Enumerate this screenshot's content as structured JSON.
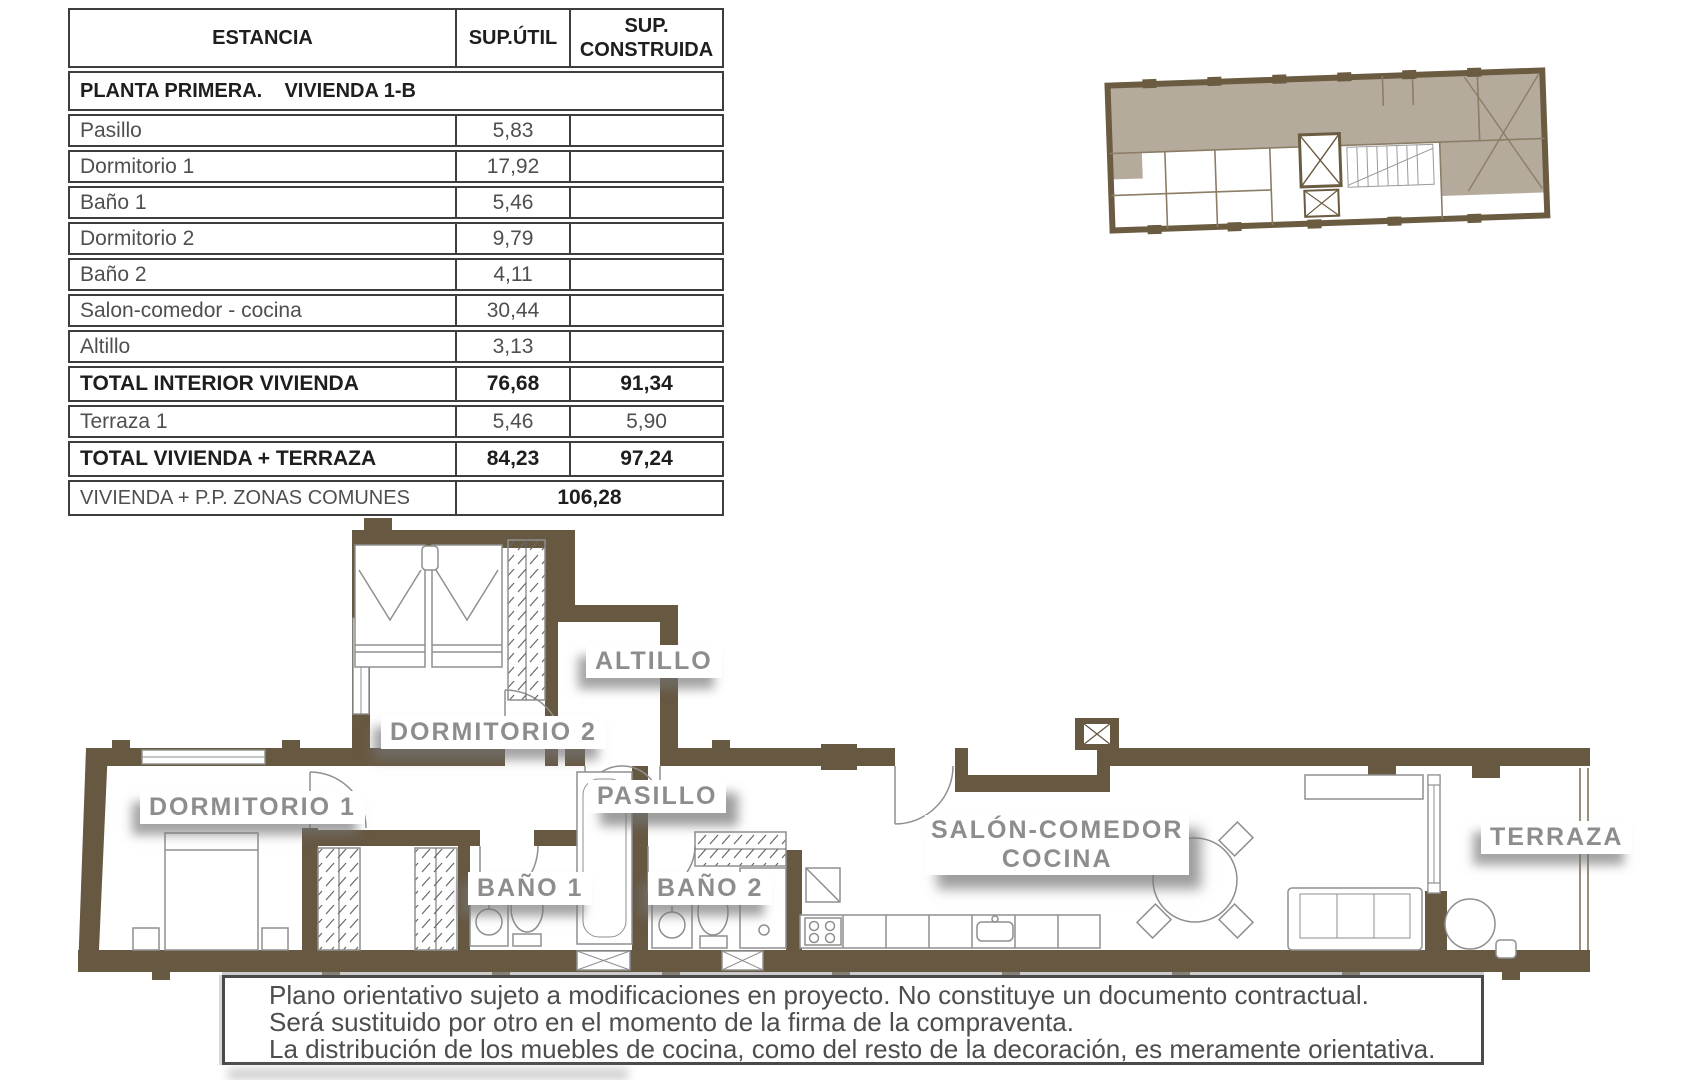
{
  "table": {
    "headers": {
      "estancia": "ESTANCIA",
      "util": "SUP.ÚTIL",
      "construida": "SUP. CONSTRUIDA"
    },
    "section_title": "PLANTA PRIMERA.    VIVIENDA 1-B",
    "rows": [
      {
        "label": "Pasillo",
        "util": "5,83",
        "construida": ""
      },
      {
        "label": "Dormitorio 1",
        "util": "17,92",
        "construida": ""
      },
      {
        "label": "Baño 1",
        "util": "5,46",
        "construida": ""
      },
      {
        "label": "Dormitorio 2",
        "util": "9,79",
        "construida": ""
      },
      {
        "label": "Baño 2",
        "util": "4,11",
        "construida": ""
      },
      {
        "label": "Salon-comedor - cocina",
        "util": "30,44",
        "construida": ""
      },
      {
        "label": "Altillo",
        "util": "3,13",
        "construida": ""
      },
      {
        "label": "TOTAL INTERIOR VIVIENDA",
        "util": "76,68",
        "construida": "91,34"
      },
      {
        "label": "Terraza 1",
        "util": "5,46",
        "construida": "5,90"
      },
      {
        "label": "TOTAL VIVIENDA + TERRAZA",
        "util": "84,23",
        "construida": "97,24"
      }
    ],
    "footer": {
      "label": "VIVIENDA + P.P. ZONAS COMUNES",
      "value": "106,28"
    }
  },
  "floorplan": {
    "labels": {
      "altillo": "ALTILLO",
      "dormitorio2": "DORMITORIO 2",
      "dormitorio1": "DORMITORIO 1",
      "pasillo": "PASILLO",
      "bano1": "BAÑO 1",
      "bano2": "BAÑO 2",
      "salon_line1": "SALÓN-COMEDOR",
      "salon_line2": "COCINA",
      "terraza": "TERRAZA"
    }
  },
  "disclaimer": {
    "lines": [
      "Plano orientativo sujeto a modificaciones en proyecto. No constituye un documento contractual.",
      "Será sustituido por otro en el momento de la firma de la compraventa.",
      "La distribución de los muebles de cocina, como del resto de la decoración, es meramente orientativa."
    ]
  },
  "colors": {
    "wall_brown": "#675842",
    "keyplan_shade": "#b5ab9d",
    "label_gray": "#8d8d8d",
    "table_border": "#3e3e3e",
    "furniture_stroke": "#8f8f8f"
  }
}
